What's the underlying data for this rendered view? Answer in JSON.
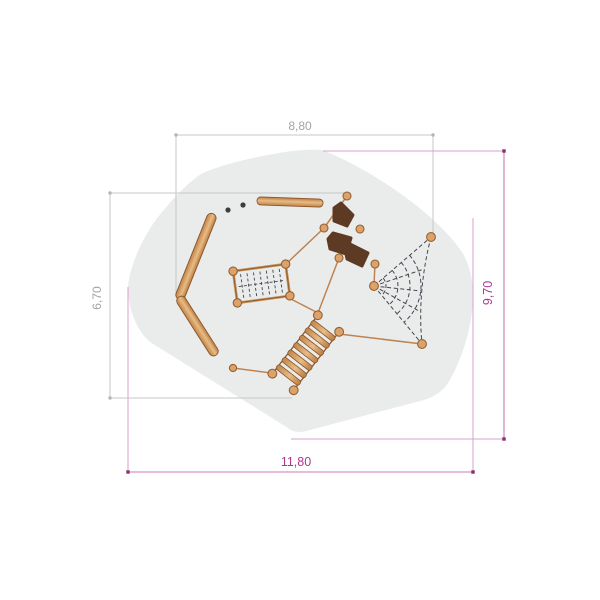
{
  "drawing": {
    "kind": "playground-equipment-plan",
    "dimensions": {
      "top": "8,80",
      "left": "6,70",
      "right": "9,70",
      "bottom": "11,80"
    },
    "colors": {
      "surface": "#eaecec",
      "wood": "#d79a62",
      "wood_light": "#e8bc86",
      "wood_outline": "#8a5427",
      "rope": "#bf8350",
      "stone_brown": "#5d3a24",
      "net_line": "#45454e",
      "dim_gray_line": "#c7c7c7",
      "dim_gray_text": "#a3a3a3",
      "dim_magenta_line": "#cb79b4",
      "dim_magenta_ext": "#d9a0c9",
      "dim_magenta_dot": "#8d2d73",
      "dim_magenta_text": "#aa3790"
    },
    "equipment_icons": [
      "balance-log-icon",
      "climbing-net-icon",
      "rope-ladder-icon",
      "stepping-stones-icon",
      "spider-net-icon"
    ]
  }
}
